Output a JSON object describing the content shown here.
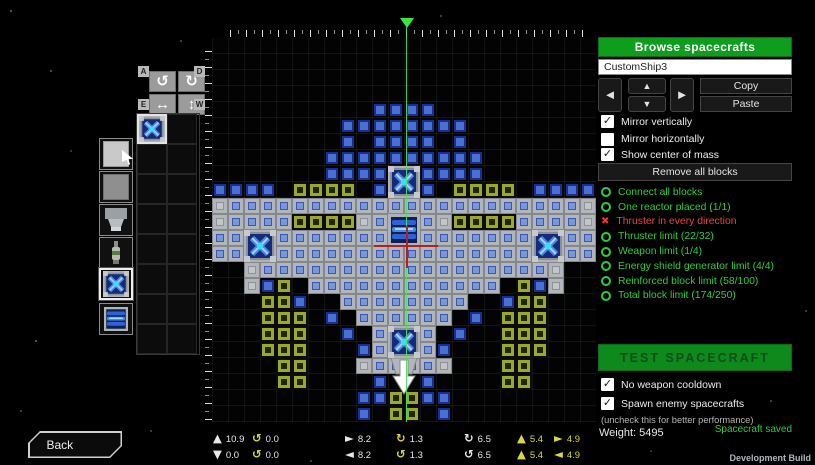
{
  "colors": {
    "accent_green": "#0f9d1e",
    "ok_green": "#2ecc40",
    "error_red": "#e84545",
    "stat_yellow": "#d9d93a",
    "block_blue": "#4a70d4",
    "block_olive": "#9aa928"
  },
  "icons": {
    "arrow_left": "◄",
    "arrow_right": "►",
    "arrow_up": "▲",
    "arrow_down": "▼",
    "rotate_ccw": "↺",
    "rotate_cw": "↻",
    "flip_h": "↔",
    "flip_v": "↕",
    "check": "✓",
    "cross": "✖"
  },
  "right_panel": {
    "browse_label": "Browse spacecrafts",
    "ship_name": "CustomShip3",
    "copy_label": "Copy",
    "paste_label": "Paste",
    "mirror_options": [
      {
        "label": "Mirror vertically",
        "checked": true
      },
      {
        "label": "Mirror horizontally",
        "checked": false
      },
      {
        "label": "Show center of mass",
        "checked": true
      }
    ],
    "remove_all_label": "Remove all blocks",
    "requirements": [
      {
        "label": "Connect all blocks",
        "ok": true
      },
      {
        "label": "One reactor placed (1/1)",
        "ok": true
      },
      {
        "label": "Thruster in every direction",
        "ok": false
      },
      {
        "label": "Thruster limit (22/32)",
        "ok": true
      },
      {
        "label": "Weapon limit (1/4)",
        "ok": true
      },
      {
        "label": "Energy shield generator limit (4/4)",
        "ok": true
      },
      {
        "label": "Reinforced block limit (58/100)",
        "ok": true
      },
      {
        "label": "Total block limit (174/250)",
        "ok": true
      }
    ],
    "test_label": "TEST SPACECRAFT",
    "test_options": [
      {
        "label": "No weapon cooldown",
        "checked": true
      },
      {
        "label": "Spawn enemy spacecrafts",
        "checked": true
      }
    ],
    "note": "(uncheck this for better performance)",
    "weight_label": "Weight: 5495",
    "saved_label": "Spacecraft saved"
  },
  "palette": {
    "rotate_pad": {
      "corner_labels": [
        "A",
        "D",
        "E",
        "W"
      ],
      "buttons": [
        "rotate-ccw",
        "rotate-cw",
        "flip-horizontal",
        "flip-vertical"
      ]
    },
    "tools": [
      {
        "id": "light-armor-block",
        "selected": false
      },
      {
        "id": "heavy-armor-block",
        "selected": false
      },
      {
        "id": "thruster-block",
        "selected": false
      },
      {
        "id": "weapon-block",
        "selected": false
      },
      {
        "id": "shield-generator-block",
        "selected": true
      },
      {
        "id": "reactor-block",
        "selected": false
      }
    ],
    "slots": {
      "rows": 8,
      "cols": 2,
      "selected_slot": 0,
      "slot_contents": {
        "0": "shield-generator-block"
      }
    }
  },
  "stats": {
    "rows": [
      [
        {
          "icon": "arrow_up",
          "color": "white",
          "value": "10.9",
          "value_color": "white"
        },
        {
          "icon": "rotate_ccw",
          "color": "yellow",
          "value": "0.0",
          "value_color": "white"
        },
        {
          "icon": "arrow_right",
          "color": "white",
          "value": "8.2",
          "value_color": "white"
        },
        {
          "icon": "rotate_cw",
          "color": "yellow",
          "value": "1.3",
          "value_color": "white"
        },
        {
          "icon": "rotate_cw",
          "color": "white",
          "value": "6.5",
          "value_color": "white"
        },
        {
          "icon": "arrow_up",
          "color": "yellow",
          "value": "5.4",
          "value_color": "yellow"
        },
        {
          "icon": "arrow_right",
          "color": "yellow",
          "value": "4.9",
          "value_color": "yellow"
        }
      ],
      [
        {
          "icon": "arrow_down",
          "color": "white",
          "value": "0.0",
          "value_color": "white"
        },
        {
          "icon": "rotate_ccw",
          "color": "yellow",
          "value": "0.0",
          "value_color": "white"
        },
        {
          "icon": "arrow_left",
          "color": "white",
          "value": "8.2",
          "value_color": "white"
        },
        {
          "icon": "rotate_ccw",
          "color": "yellow",
          "value": "1.3",
          "value_color": "white"
        },
        {
          "icon": "rotate_ccw",
          "color": "white",
          "value": "6.5",
          "value_color": "white"
        },
        {
          "icon": "arrow_up",
          "color": "yellow",
          "value": "5.4",
          "value_color": "yellow"
        },
        {
          "icon": "arrow_left",
          "color": "yellow",
          "value": "4.9",
          "value_color": "yellow"
        }
      ]
    ]
  },
  "ship": {
    "legend": {
      "b": "basic-block",
      "h": "hull-block-with-core",
      "g": "armor-block",
      "y": "reinforced-block",
      ".": "empty"
    },
    "map": [
      "........................",
      "........................",
      "........................",
      "........................",
      "..........bbbb..........",
      "........bbbbbbbb........",
      "........b.bbbb.b........",
      ".......bbbbbbbbbb.......",
      ".......bbbb..bbbb.......",
      "bbbb.yyyy.b..b.yyyy.bbbb",
      "ghhhhhhhhhhhhhhhhhhhhhhg",
      "ghhhhyyyyghhhhgyyyyhhhhg",
      "hhhhhhhhhhhhhhhhhhhhhhhh",
      "hhhhhhhhhhhhhhhhhhhhhhhh",
      "..ghhhhhhhhhhhhhhhhhhg..",
      "..gby.hhhhhhhhhhhh.ybg..",
      "...yyb..hhhhhhhh..byy...",
      "...yyy.b.hhhhhh.b.yyy...",
      "...yyy..b.hhhh.b..yyy...",
      "...yyy...bhhhhb...yyy...",
      "....yy...ghhhhg...yy....",
      "....yy....b..b....yy....",
      ".........bbyybb.........",
      ".........b.yy.b........."
    ],
    "specials": [
      {
        "type": "shield",
        "col": 11,
        "row": 8
      },
      {
        "type": "reactor",
        "col": 11,
        "row": 11
      },
      {
        "type": "shield",
        "col": 2,
        "row": 12
      },
      {
        "type": "shield",
        "col": 20,
        "row": 12
      },
      {
        "type": "shield",
        "col": 11,
        "row": 18
      },
      {
        "type": "thruster_arrow",
        "col": 11,
        "row": 20
      }
    ]
  },
  "footer": {
    "back_label": "Back",
    "dev_build_label": "Development Build"
  }
}
